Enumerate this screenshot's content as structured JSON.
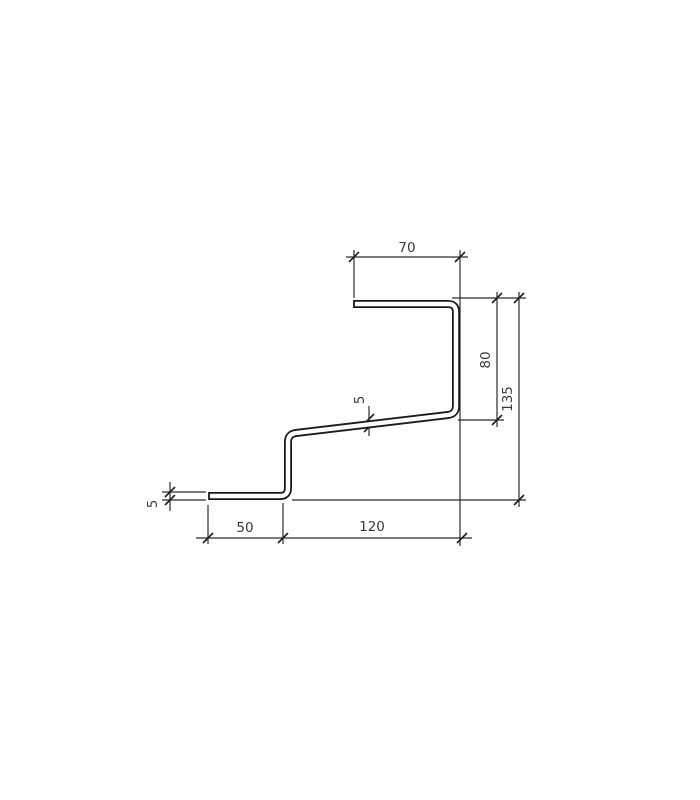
{
  "page": {
    "background": "#ffffff",
    "line_color": "#2b2b2b",
    "kind": "technical drawing - bent sheet metal profile cross-section"
  },
  "drawing": {
    "unit_system": "mm (implied, unlabeled)",
    "dimensions": {
      "top_flange_width": "70",
      "upper_right_height": "80",
      "total_right_height": "135",
      "web_thickness": "5",
      "bottom_flange_thickness": "5",
      "bottom_left_width": "50",
      "bottom_right_width": "120"
    }
  }
}
